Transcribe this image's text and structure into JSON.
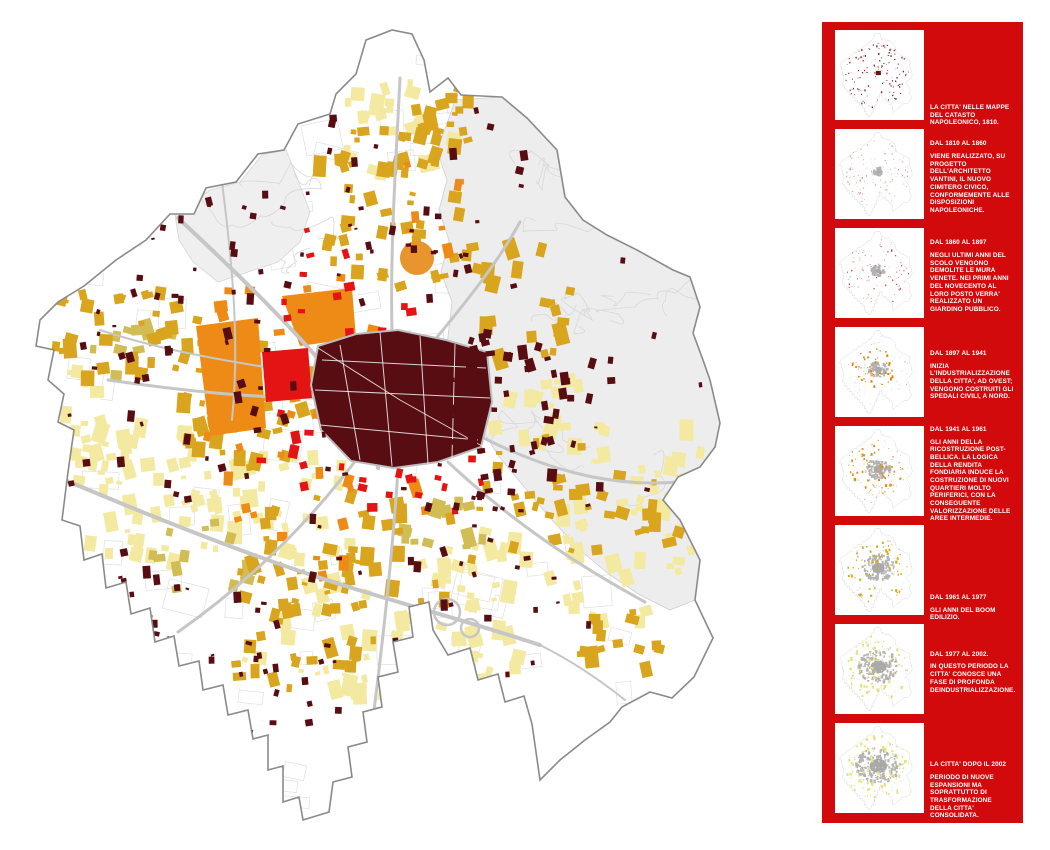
{
  "map": {
    "name": "carta della crescita urbana",
    "palette": {
      "historic_core": "#570d11",
      "red": "#e41414",
      "orange": "#ee8b17",
      "gold": "#d9a51e",
      "khaki": "#d2bd55",
      "pale_yellow": "#f3e9a0",
      "hill_gray": "#ededed",
      "hill_line": "#d8d8d8",
      "road_gray": "#c6c6c6",
      "boundary_gray": "#8a8a8a",
      "urban_gray": "#b3b3b3"
    }
  },
  "sidebar": {
    "background": "#d20a0c",
    "text_color": "#ffffff",
    "panels": [
      {
        "title": "LA CITTA' NELLE MAPPE DEL CATASTO NAPOLEONICO, 1810.",
        "body": ""
      },
      {
        "title": "DAL 1810 AL 1860",
        "body": "VIENE REALIZZATO, SU PROGETTO DELL'ARCHITETTO VANTINI, IL NUOVO CIMITERO CIVICO, CONFORMEMENTE ALLE DISPOSIZIONI NAPOLEONICHE."
      },
      {
        "title": "DAL 1860 AL 1897",
        "body": "NEGLI ULTIMI ANNI DEL SCOLO VENGONO DEMOLITE LE MURA VENETE. NEI PRIMI ANNI DEL NOVECENTO AL LORO POSTO VERRA' REALIZZATO UN GIARDINO PUBBLICO."
      },
      {
        "title": "DAL 1897 AL 1941",
        "body": "INIZIA L'INDUSTRIALIZZAZIONE DELLA CITTA', AD OVEST; VENGONO COSTRUITI GLI SPEDALI CIVILI, A NORD."
      },
      {
        "title": "DAL 1941 AL 1961",
        "body": "GLI ANNI DELLA RICOSTRUZIONE POST-BELLICA. LA LOGICA DELLA RENDITA FONDIARIA INDUCE LA COSTRUZIONE DI NUOVI QUARTIERI MOLTO PERIFERICI, CON LA CONSEGUENTE VALORIZZAZIONE DELLE AREE INTERMEDIE."
      },
      {
        "title": "DAL 1961 AL 1977",
        "body": "GLI ANNI DEL BOOM EDILIZIO."
      },
      {
        "title": "DAL 1977 AL 2002.",
        "body": "IN QUESTO PERIODO LA CITTA' CONOSCE UNA FASE DI PROFONDA DEINDUSTRIALIZZAZIONE."
      },
      {
        "title": "LA CITTA' DOPO IL 2002",
        "body": "PERIODO DI NUOVE ESPANSIONI MA SOPRATTUTTO DI TRASFORMAZIONE DELLA CITTA' CONSOLIDATA."
      }
    ]
  }
}
